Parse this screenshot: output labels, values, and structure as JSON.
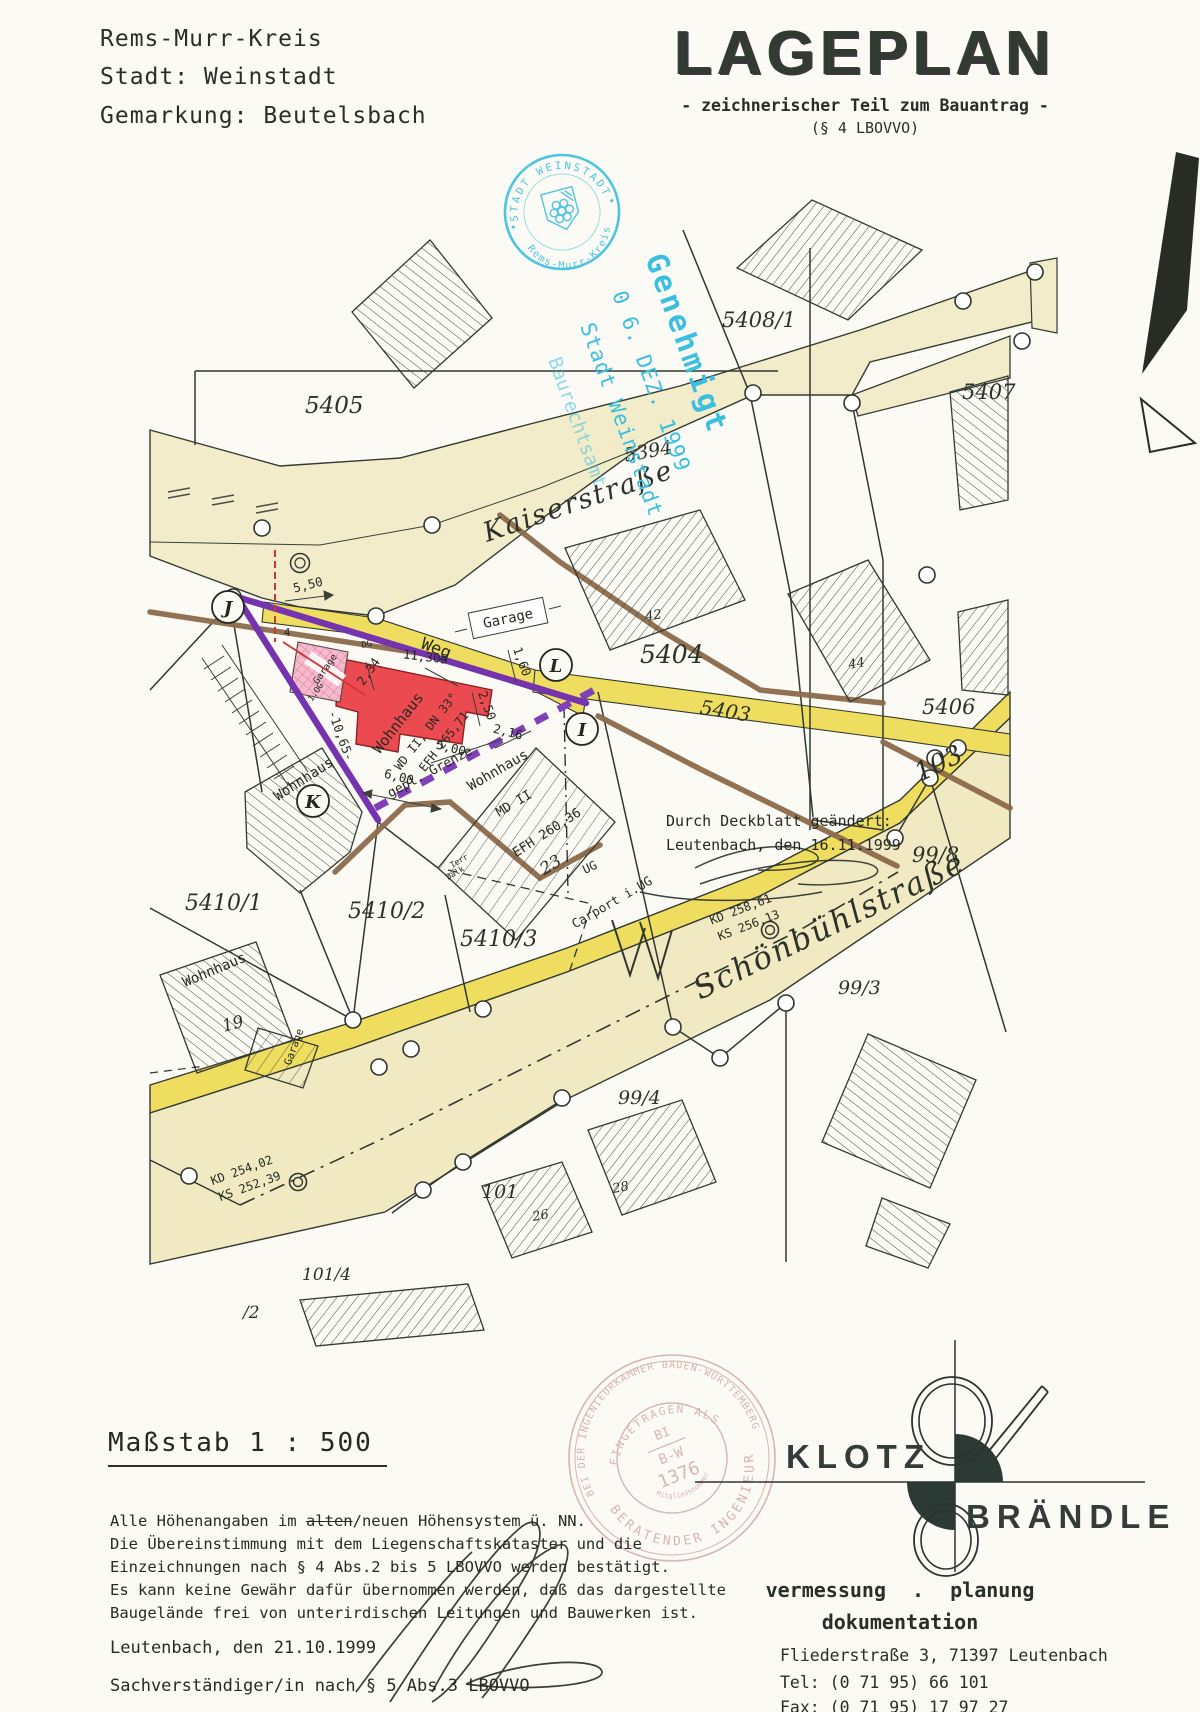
{
  "header": {
    "line1": "Rems-Murr-Kreis",
    "line2": "Stadt: Weinstadt",
    "line3": "Gemarkung: Beutelsbach"
  },
  "title": {
    "main": "LAGEPLAN",
    "sub": "- zeichnerischer Teil zum Bauantrag -",
    "par": "(§ 4 LBOVVO)"
  },
  "approval_stamp": {
    "ring_top": "STADT WEINSTADT",
    "ring_bottom": "Rems-Murr-Kreis",
    "l1": "Genehmigt",
    "l2": "0 6. DEZ. 1999",
    "l3": "Stadt Weinstadt",
    "l4": "Baurechtsamt"
  },
  "map": {
    "labels": {
      "kaiser": "Kaiserstraße",
      "schoen": "Schönbühlstraße",
      "schoen_no": "103",
      "weg": "Weg",
      "p5405": "5405",
      "p5408": "5408/1",
      "p5407": "5407",
      "p5394": "5394",
      "p5404": "5404",
      "p5406": "5406",
      "p5403": "5403",
      "p5410_1": "5410/1",
      "p5410_2": "5410/2",
      "p5410_3": "5410/3",
      "p99_8": "99/8",
      "p99_3": "99/3",
      "p99_4": "99/4",
      "p101": "101",
      "p101_4": "101/4",
      "p_2": "/2",
      "p26": "26",
      "p28": "28",
      "p42": "42",
      "p44": "44",
      "p19": "19",
      "p23": "23",
      "red1": "Wohnhaus",
      "red2": "WD II, DN 33°",
      "red3": "EFH 265,71",
      "wh_k": "Wohnhaus",
      "wh_23": "Wohnhaus",
      "md2": "MD II",
      "efh23": "EFH 260,36",
      "wh_19": "Wohnhaus",
      "gar19": "Garage",
      "gar_box": "Garage",
      "gar_pink": "Garage",
      "dg": "DG",
      "og": "1.OG",
      "terr": "Terr",
      "balk": "Balk",
      "ug": "UG",
      "carport": "Carport i.UG",
      "kd1": "KD 258,61",
      "ks1": "KS 256,13",
      "kd2": "KD 254,02",
      "ks2": "KS 252,39",
      "d550": "5,50",
      "d4": "4",
      "d234": "2,34",
      "d11305": "11,305",
      "d1065": "-10,65-",
      "d600": "6,00",
      "d500": "5,00",
      "d216": "2,16",
      "d250": "2,50",
      "d160": "1,60",
      "gepl": "gepl. Grenze",
      "cJ": "J",
      "cK": "K",
      "cL": "L",
      "cI": "I",
      "cS": "S",
      "note1": "Durch Deckblatt geändert:",
      "note2": "Leutenbach, den 16.11.1999"
    }
  },
  "scale_label": "Maßstab  1 : 500",
  "legal": {
    "l1a": "Alle Höhenangaben im ",
    "l1b": "alten",
    "l1c": "/neuen Höhensystem ü. NN.",
    "l2": "Die Übereinstimmung mit dem Liegenschaftskataster und die",
    "l3": "Einzeichnungen nach § 4 Abs.2 bis 5 LBOVVO werden bestätigt.",
    "l4": "Es kann keine Gewähr dafür übernommen werden, daß das dargestellte",
    "l5": "Baugelände frei von unterirdischen Leitungen und Bauwerken ist.",
    "date_line": "Leutenbach, den 21.10.1999",
    "expert_line": "Sachverständiger/in nach § 5 Abs.3 LBOVVO"
  },
  "engineer_stamp": {
    "outer": "BEI DER INGENIEURKAMMER BADEN-WÜRTTEMBERG",
    "arc": "EINGETRAGEN ALS",
    "bi": "BI",
    "bw": "B-W",
    "num": "1376",
    "member": "Mitgliedsnummer",
    "bottom": "BERATENDER INGENIEUR"
  },
  "firm": {
    "n1": "KLOTZ",
    "n2": "BRÄNDLE",
    "s1": "vermessung . planung",
    "s2": "dokumentation",
    "addr": "Fliederstraße 3, 71397 Leutenbach",
    "tel": "Tel: (0 71 95) 66 101",
    "fax": "Fax: (0 71 95) 17 97 27"
  }
}
